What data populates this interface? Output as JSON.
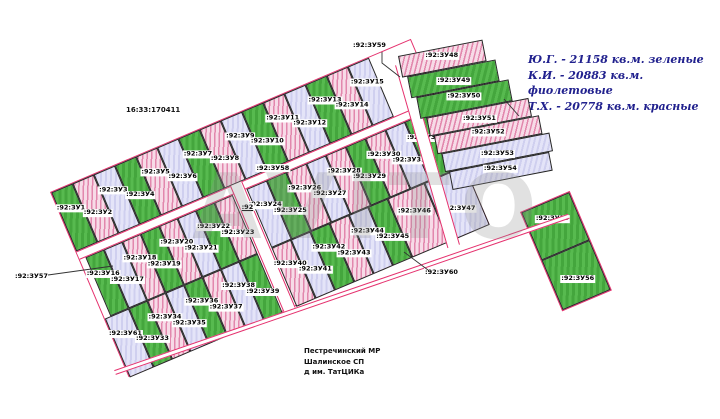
{
  "map": {
    "quarter_label": "16:33:170411",
    "parent_parcel_label": ":92",
    "watermark": "AVITO",
    "location": {
      "line1": "Пестречинский МР",
      "line2": "Шалинское СП",
      "line3": "д им. ТатЦИКа"
    },
    "legend": [
      {
        "owner": "Ю.Г.",
        "area_sqm": 21158,
        "color_name": "зеленые",
        "color": "#4fae48",
        "text": "Ю.Г. - 21158 кв.м. зеленые"
      },
      {
        "owner": "К.И.",
        "area_sqm": 20883,
        "color_name": "фиолетовые",
        "color": "#d9d9f2",
        "text": "К.И. - 20883 кв.м. фиолетовые"
      },
      {
        "owner": "Т.Х.",
        "area_sqm": 20778,
        "color_name": "красные",
        "color": "#eeb9cb",
        "text": "Т.Х. - 20778 кв.м. красные"
      }
    ],
    "colors": {
      "boundary": "#e5316e",
      "parcel_border": "#262626",
      "legend_text": "#21218e"
    },
    "roads": [
      {
        "id": 57,
        "label": ":92:ЗУ57"
      },
      {
        "id": 58,
        "label": ":92:ЗУ58"
      },
      {
        "id": 59,
        "label": ":92:ЗУ59"
      },
      {
        "id": 60,
        "label": ":92:ЗУ60"
      }
    ],
    "rows": [
      {
        "name": "row1",
        "parcels": [
          {
            "id": 1,
            "label": ":92:ЗУ1",
            "color": "green"
          },
          {
            "id": 2,
            "label": ":92:ЗУ2",
            "color": "pink"
          },
          {
            "id": 3,
            "label": ":92:ЗУ3",
            "color": "violet"
          },
          {
            "id": 4,
            "label": ":92:ЗУ4",
            "color": "green"
          },
          {
            "id": 5,
            "label": ":92:ЗУ5",
            "color": "pink"
          },
          {
            "id": 6,
            "label": ":92:ЗУ6",
            "color": "violet"
          },
          {
            "id": 7,
            "label": ":92:ЗУ7",
            "color": "green"
          },
          {
            "id": 8,
            "label": ":92:ЗУ8",
            "color": "pink"
          },
          {
            "id": 9,
            "label": ":92:ЗУ9",
            "color": "violet"
          },
          {
            "id": 10,
            "label": ":92:ЗУ10",
            "color": "green"
          },
          {
            "id": 11,
            "label": ":92:ЗУ11",
            "color": "pink"
          },
          {
            "id": 12,
            "label": ":92:ЗУ12",
            "color": "violet"
          },
          {
            "id": 13,
            "label": ":92:ЗУ13",
            "color": "green"
          },
          {
            "id": 14,
            "label": ":92:ЗУ14",
            "color": "pink"
          },
          {
            "id": 15,
            "label": ":92:ЗУ15",
            "color": "violet"
          }
        ]
      },
      {
        "name": "row2l",
        "parcels": [
          {
            "id": 16,
            "label": ":92:ЗУ16",
            "color": "green"
          },
          {
            "id": 17,
            "label": ":92:ЗУ17",
            "color": "violet"
          },
          {
            "id": 18,
            "label": ":92:ЗУ18",
            "color": "pink"
          },
          {
            "id": 19,
            "label": ":92:ЗУ19",
            "color": "green"
          },
          {
            "id": 20,
            "label": ":92:ЗУ20",
            "color": "pink"
          },
          {
            "id": 21,
            "label": ":92:ЗУ21",
            "color": "violet"
          },
          {
            "id": 22,
            "label": ":92:ЗУ22",
            "color": "green"
          },
          {
            "id": 23,
            "label": ":92:ЗУ23",
            "color": "pink"
          }
        ]
      },
      {
        "name": "row2r",
        "parcels": [
          {
            "id": 24,
            "label": ":92:ЗУ24",
            "color": "violet"
          },
          {
            "id": 25,
            "label": ":92:ЗУ25",
            "color": "green"
          },
          {
            "id": 26,
            "label": ":92:ЗУ26",
            "color": "pink"
          },
          {
            "id": 27,
            "label": ":92:ЗУ27",
            "color": "violet"
          },
          {
            "id": 28,
            "label": ":92:ЗУ28",
            "color": "pink"
          },
          {
            "id": 29,
            "label": ":92:ЗУ29",
            "color": "green"
          },
          {
            "id": 30,
            "label": ":92:ЗУ30",
            "color": "pink"
          },
          {
            "id": 31,
            "label": ":92:ЗУ31",
            "color": "violet"
          },
          {
            "id": 32,
            "label": ":92:ЗУ32",
            "color": "green"
          }
        ]
      },
      {
        "name": "row3l",
        "parcels": [
          {
            "id": 61,
            "label": ":92:ЗУ61",
            "color": "violet",
            "w": 26
          },
          {
            "id": 33,
            "label": ":92:ЗУ33",
            "color": "green"
          },
          {
            "id": 34,
            "label": ":92:ЗУ34",
            "color": "pink"
          },
          {
            "id": 35,
            "label": ":92:ЗУ35",
            "color": "violet"
          },
          {
            "id": 36,
            "label": ":92:ЗУ36",
            "color": "green"
          },
          {
            "id": 37,
            "label": ":92:ЗУ37",
            "color": "pink"
          },
          {
            "id": 38,
            "label": ":92:ЗУ38",
            "color": "violet"
          },
          {
            "id": 39,
            "label": ":92:ЗУ39",
            "color": "green"
          }
        ]
      },
      {
        "name": "row3r",
        "parcels": [
          {
            "id": 40,
            "label": ":92:ЗУ40",
            "color": "pink"
          },
          {
            "id": 41,
            "label": ":92:ЗУ41",
            "color": "violet"
          },
          {
            "id": 42,
            "label": ":92:ЗУ42",
            "color": "green"
          },
          {
            "id": 43,
            "label": ":92:ЗУ43",
            "color": "pink"
          },
          {
            "id": 44,
            "label": ":92:ЗУ44",
            "color": "violet"
          },
          {
            "id": 45,
            "label": ":92:ЗУ45",
            "color": "green"
          },
          {
            "id": 46,
            "label": ":92:ЗУ46",
            "color": "pink",
            "w": 40
          },
          {
            "id": 47,
            "label": ":92:ЗУ47",
            "color": "violet",
            "w": 44
          }
        ]
      },
      {
        "name": "rightblock",
        "parcels": [
          {
            "id": 48,
            "label": ":92:ЗУ48",
            "color": "pink",
            "w": 86,
            "h": 22,
            "ml": 0
          },
          {
            "id": 49,
            "label": ":92:ЗУ49",
            "color": "green",
            "w": 90,
            "h": 22,
            "ml": 5
          },
          {
            "id": 50,
            "label": ":92:ЗУ50",
            "color": "green",
            "w": 94,
            "h": 22,
            "ml": 10
          },
          {
            "id": 51,
            "label": ":92:ЗУ51",
            "color": "pink",
            "w": 104,
            "h": 19,
            "ml": 16
          },
          {
            "id": 52,
            "label": ":92:ЗУ52",
            "color": "pink",
            "w": 107,
            "h": 19,
            "ml": 20
          },
          {
            "id": 53,
            "label": ":92:ЗУ53",
            "color": "violet",
            "w": 110,
            "h": 19,
            "ml": 24
          },
          {
            "id": 54,
            "label": ":92:ЗУ54",
            "color": "violet",
            "w": 102,
            "h": 19,
            "ml": 28
          }
        ]
      },
      {
        "name": "seblock",
        "parcels": [
          {
            "id": 55,
            "label": ":92:ЗУ55",
            "color": "green",
            "w": 52,
            "h": 52
          },
          {
            "id": 56,
            "label": ":92:ЗУ56",
            "color": "green",
            "w": 52,
            "h": 54
          }
        ]
      }
    ]
  }
}
